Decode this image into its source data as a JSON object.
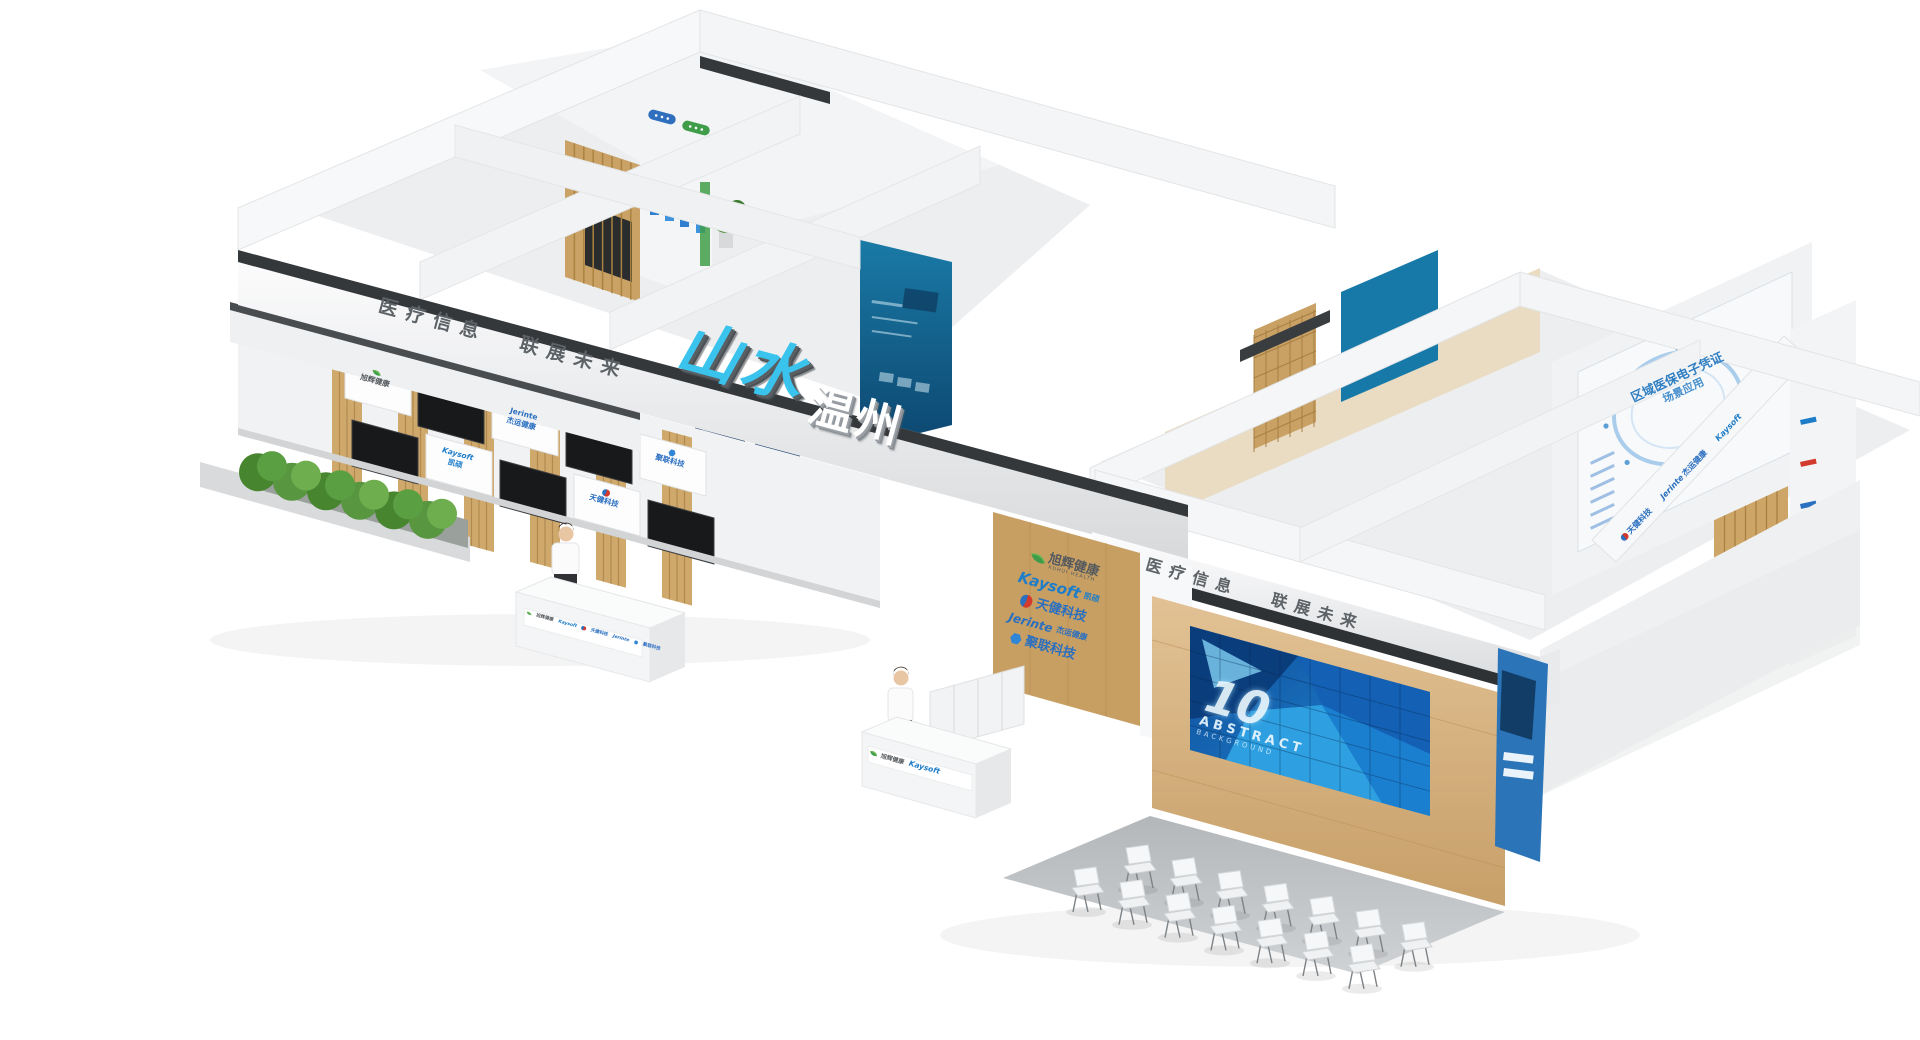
{
  "scene": {
    "description": "3D rendering of a medical-information exhibition booth, isometric view on white background",
    "background_color": "#ffffff"
  },
  "branding": {
    "logo_script": "山水",
    "logo_block": "温州",
    "logo_script_color": "#3ac3ec",
    "slogan_left": "医疗信息",
    "slogan_right": "联展未来"
  },
  "companies": [
    {
      "name": "旭辉健康",
      "latin": "XUHUI HEALTH",
      "icon": "leaf-icon",
      "text_color": "#555a5e",
      "icon_color": "#3f9d49"
    },
    {
      "name": "Kaysoft",
      "cn": "凯硕",
      "icon": "kaysoft-wordmark",
      "text_color": "#1e7dc8",
      "icon_color": "#1e7dc8"
    },
    {
      "name": "天健科技",
      "icon": "globe-icon",
      "text_color": "#2a6fc0",
      "icon_color": "#d23a2e"
    },
    {
      "name": "Jerinte",
      "cn": "杰运健康",
      "icon": "jerinte-wordmark",
      "text_color": "#2a6fc0",
      "icon_color": "#2a6fc0"
    },
    {
      "name": "聚联科技",
      "icon": "hexagon-icon",
      "text_color": "#2a6fc0",
      "icon_color": "#2f86d6"
    }
  ],
  "video_wall": {
    "number": "10",
    "word": "ABSTRACT",
    "sub": "BACKGROUND"
  },
  "ne_poster": {
    "line1": "区域医保电子凭证",
    "line2": "场景应用"
  },
  "ceiling_signs": [
    {
      "color": "#2f6fbe"
    },
    {
      "color": "#3f9d49"
    }
  ]
}
